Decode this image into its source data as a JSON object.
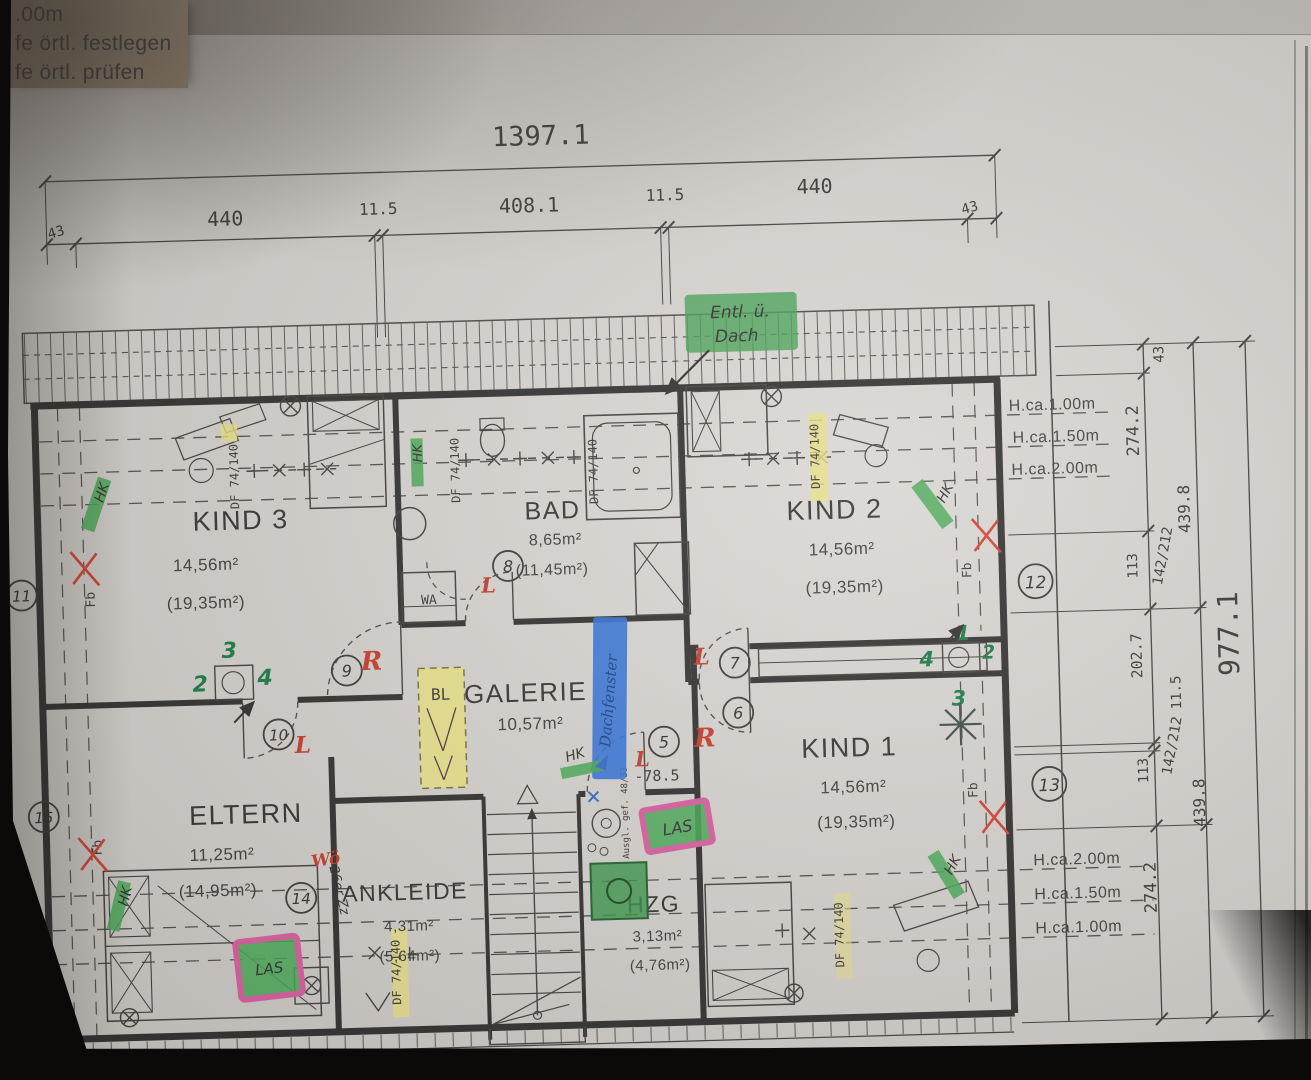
{
  "margin_notes": {
    "l1": ".00m",
    "l2": "fe örtl. festlegen",
    "l3": "fe örtl. prüfen"
  },
  "top_dims": {
    "total": "1397.1",
    "seg": [
      "43",
      "440",
      "11.5",
      "408.1",
      "11.5",
      "440",
      "43"
    ]
  },
  "right_dims": {
    "total": "977.1",
    "s43": "43",
    "s2742a": "274.2",
    "s2742b": "274.2",
    "s113a": "113",
    "s113b": "113",
    "s142a": "142/212",
    "s142b": "142/212",
    "s4398a": "439.8",
    "s4398b": "439.8",
    "s2027": "202.7",
    "s115": "11.5"
  },
  "height_labels_top": [
    "H.ca.1.00m",
    "H.ca.1.50m",
    "H.ca.2.00m"
  ],
  "height_labels_bottom": [
    "H.ca.2.00m",
    "H.ca.1.50m",
    "H.ca.1.00m"
  ],
  "rooms": {
    "kind3": {
      "name": "KIND 3",
      "area": "14,56m²",
      "gross": "(19,35m²)"
    },
    "bad": {
      "name": "BAD",
      "area": "8,65m²",
      "gross": "(11,45m²)"
    },
    "kind2": {
      "name": "KIND 2",
      "area": "14,56m²",
      "gross": "(19,35m²)"
    },
    "galerie": {
      "name": "GALERIE",
      "area": "10,57m²"
    },
    "eltern": {
      "name": "ELTERN",
      "area": "11,25m²",
      "gross": "(14,95m²)"
    },
    "ankleide": {
      "name": "ANKLEIDE",
      "area": "4,31m²",
      "gross": "(5,64m²)"
    },
    "hzg": {
      "name": "HZG",
      "area": "3,13m²",
      "gross": "(4,76m²)"
    },
    "kind1": {
      "name": "KIND 1",
      "area": "14,56m²",
      "gross": "(19,35m²)"
    }
  },
  "plan_labels": {
    "wa": "WA",
    "bl": "BL",
    "df": "DF 74/140",
    "level": "-78.5",
    "ausgleich": "Ausgl. gef. 48/33"
  },
  "hand": {
    "vent1": "Entl. ü.",
    "vent2": "Dach",
    "hk": "HK",
    "fb": "Fb",
    "las": "LAS",
    "woe": "Wö",
    "zz": "26er Zz",
    "blue": "Dachfenster",
    "r": "R",
    "l": "L",
    "c5": "5",
    "c6": "6",
    "c7": "7",
    "c8": "8",
    "c9": "9",
    "c10": "10",
    "c11": "11",
    "c12": "12",
    "c13": "13",
    "c14": "14",
    "c15": "15",
    "n1": "1",
    "n2": "2",
    "n3": "3",
    "n4": "4"
  }
}
